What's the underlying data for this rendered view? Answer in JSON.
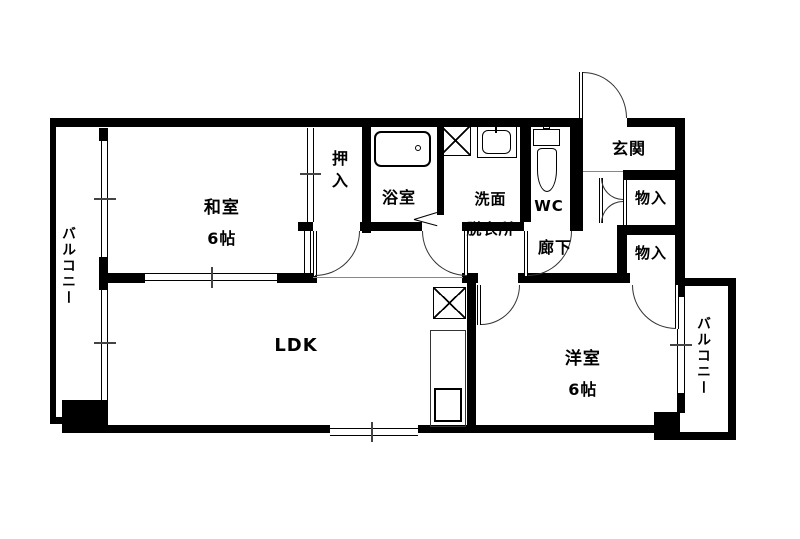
{
  "plan": {
    "title": "2LDK apartment floor plan",
    "background_color": "#ffffff",
    "wall_color": "#000000",
    "rooms": {
      "balcony_left": {
        "label": "バルコニー"
      },
      "washitsu": {
        "name": "和室",
        "size": "6帖"
      },
      "oshiire": {
        "label": "押入"
      },
      "yokushitsu": {
        "label": "浴室"
      },
      "senmen": {
        "line1": "洗面",
        "line2": "脱衣所"
      },
      "wc": {
        "label": "WC"
      },
      "genkan": {
        "label": "玄関"
      },
      "monoire_upper": {
        "label": "物入"
      },
      "monoire_lower": {
        "label": "物入"
      },
      "rouka": {
        "label": "廊下"
      },
      "ldk": {
        "label": "LDK"
      },
      "yoshitsu": {
        "name": "洋室",
        "size": "6帖"
      },
      "balcony_right": {
        "label": "バルコニー"
      }
    },
    "fixtures": [
      "bathtub",
      "toilet",
      "washbasin",
      "washing-machine-pan",
      "refrigerator-space",
      "kitchen-counter",
      "kitchen-sink"
    ]
  }
}
